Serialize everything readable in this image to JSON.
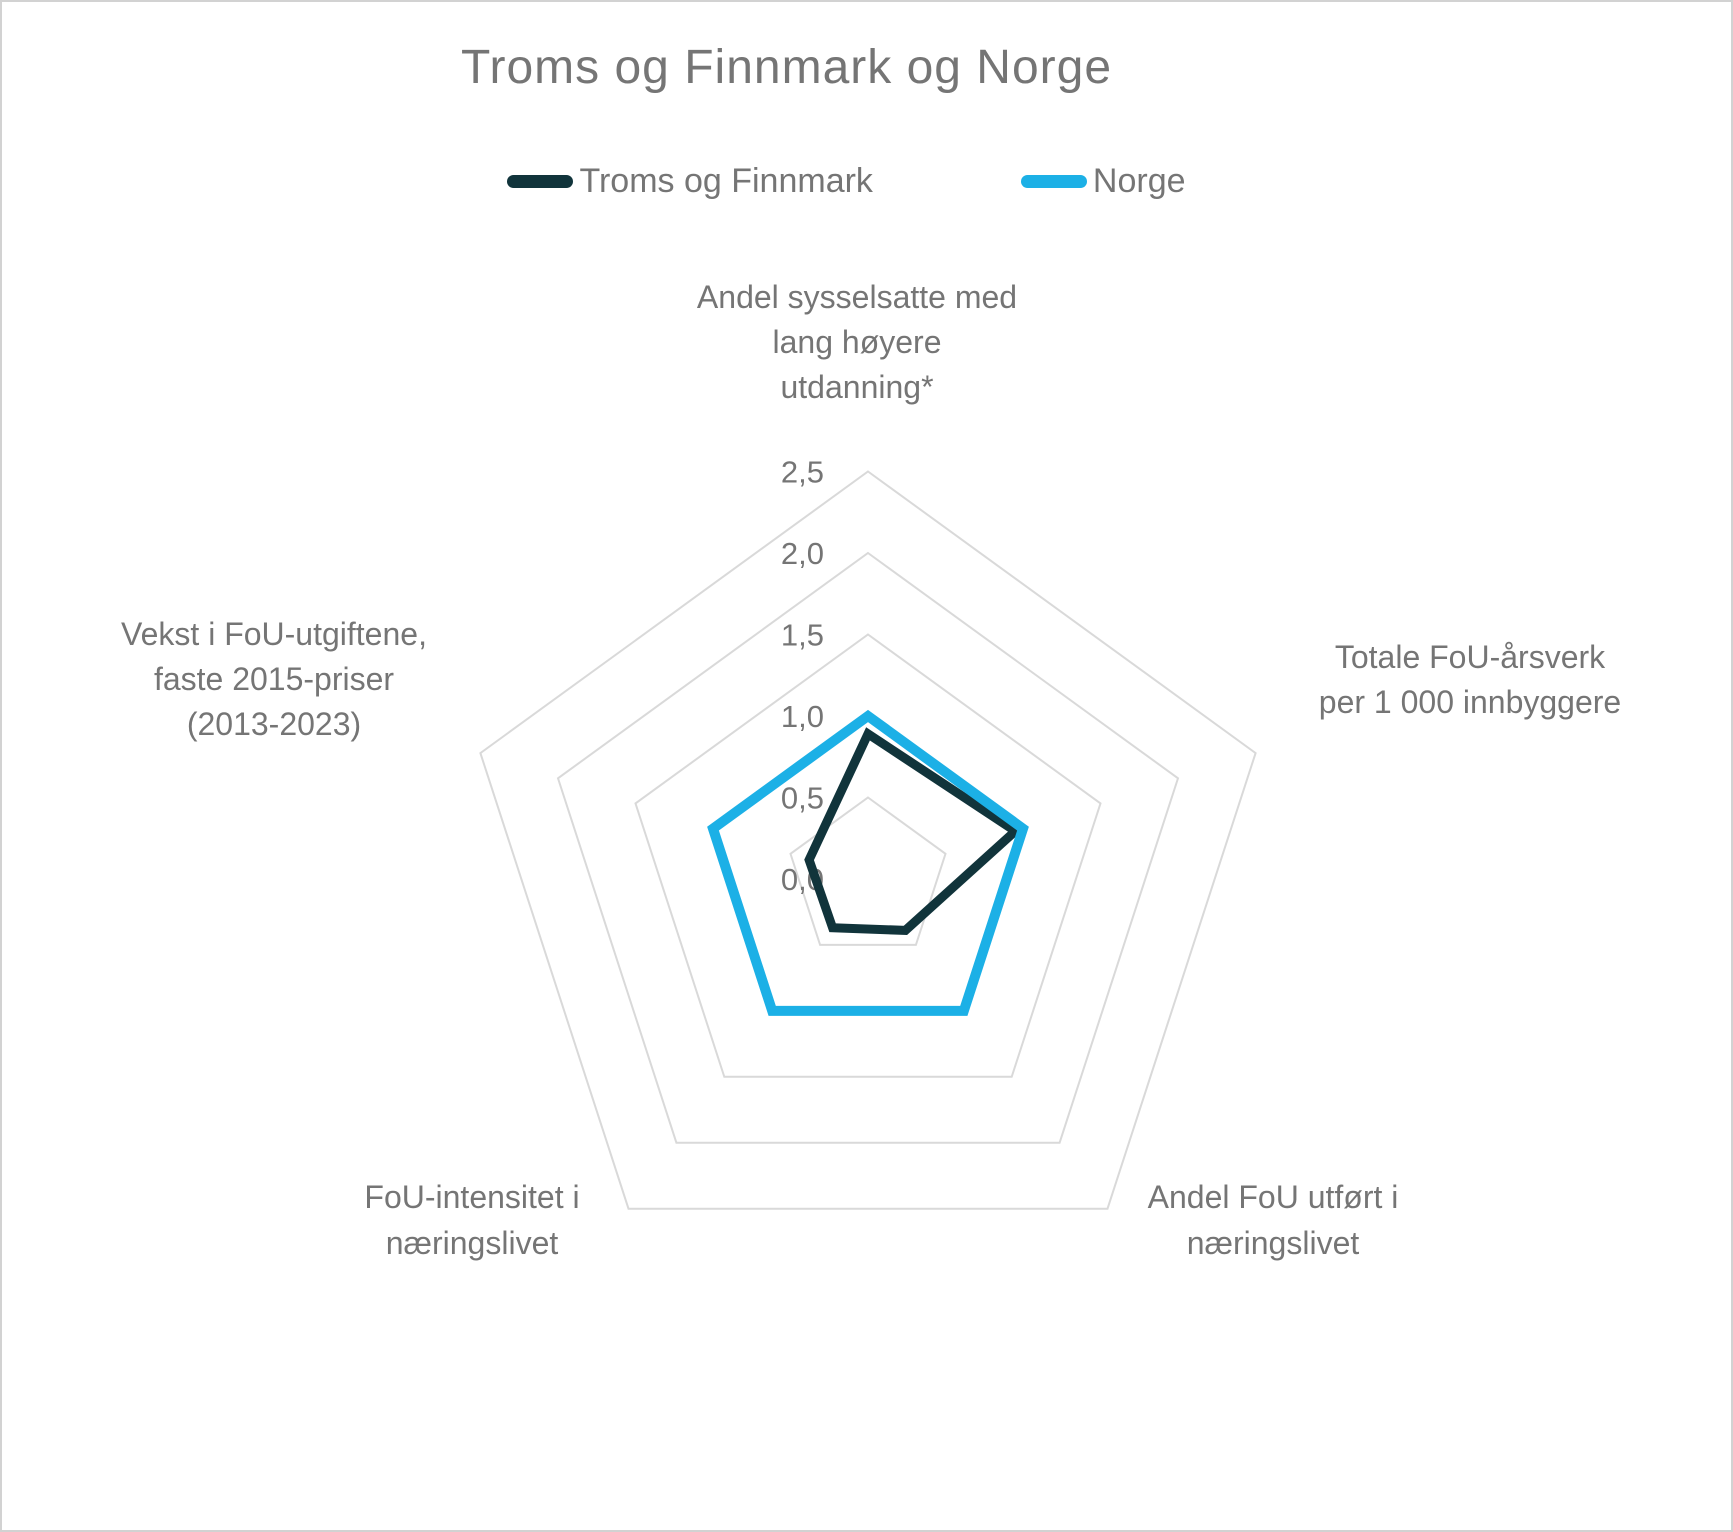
{
  "title": "Troms og Finnmark og Norge",
  "legend": [
    {
      "label": "Troms og Finnmark",
      "color": "#11343b"
    },
    {
      "label": "Norge",
      "color": "#1cb0e6"
    }
  ],
  "colors": {
    "troms_og_finnmark": "#11343b",
    "norge": "#1cb0e6",
    "grid": "#d9d9d9",
    "text": "#757575",
    "frame_border": "#d2d2d2"
  },
  "chart_data": {
    "type": "radar",
    "title": "Troms og Finnmark og Norge",
    "categories": [
      "Andel sysselsatte med lang høyere utdanning*",
      "Totale FoU-årsverk per 1 000 innbyggere",
      "Andel FoU utført i næringslivet",
      "FoU-intensitet i næringslivet",
      "Vekst i FoU-utgiftene, faste 2015-priser (2013-2023)"
    ],
    "axis_label_lines": [
      [
        "Andel sysselsatte med",
        "lang høyere",
        "utdanning*"
      ],
      [
        "Totale FoU-årsverk",
        "per 1 000 innbyggere"
      ],
      [
        "Andel FoU utført i",
        "næringslivet"
      ],
      [
        "FoU-intensitet i",
        "næringslivet"
      ],
      [
        "Vekst i FoU-utgiftene,",
        "faste 2015-priser",
        "(2013-2023)"
      ]
    ],
    "series": [
      {
        "name": "Troms og Finnmark",
        "color": "#11343b",
        "values": [
          0.89,
          0.95,
          0.39,
          0.37,
          0.38
        ]
      },
      {
        "name": "Norge",
        "color": "#1cb0e6",
        "values": [
          1.0,
          1.0,
          1.0,
          1.0,
          1.0
        ]
      }
    ],
    "r_axis": {
      "min": 0,
      "max": 2.5,
      "step": 0.5,
      "ticks": [
        {
          "v": 0.0,
          "label": "0,0"
        },
        {
          "v": 0.5,
          "label": "0,5"
        },
        {
          "v": 1.0,
          "label": "1,0"
        },
        {
          "v": 1.5,
          "label": "1,5"
        },
        {
          "v": 2.0,
          "label": "2,0"
        },
        {
          "v": 2.5,
          "label": "2,5"
        }
      ]
    },
    "grid": true,
    "grid_shape": "pentagon",
    "radial_spokes": false,
    "legend_position": "top"
  }
}
